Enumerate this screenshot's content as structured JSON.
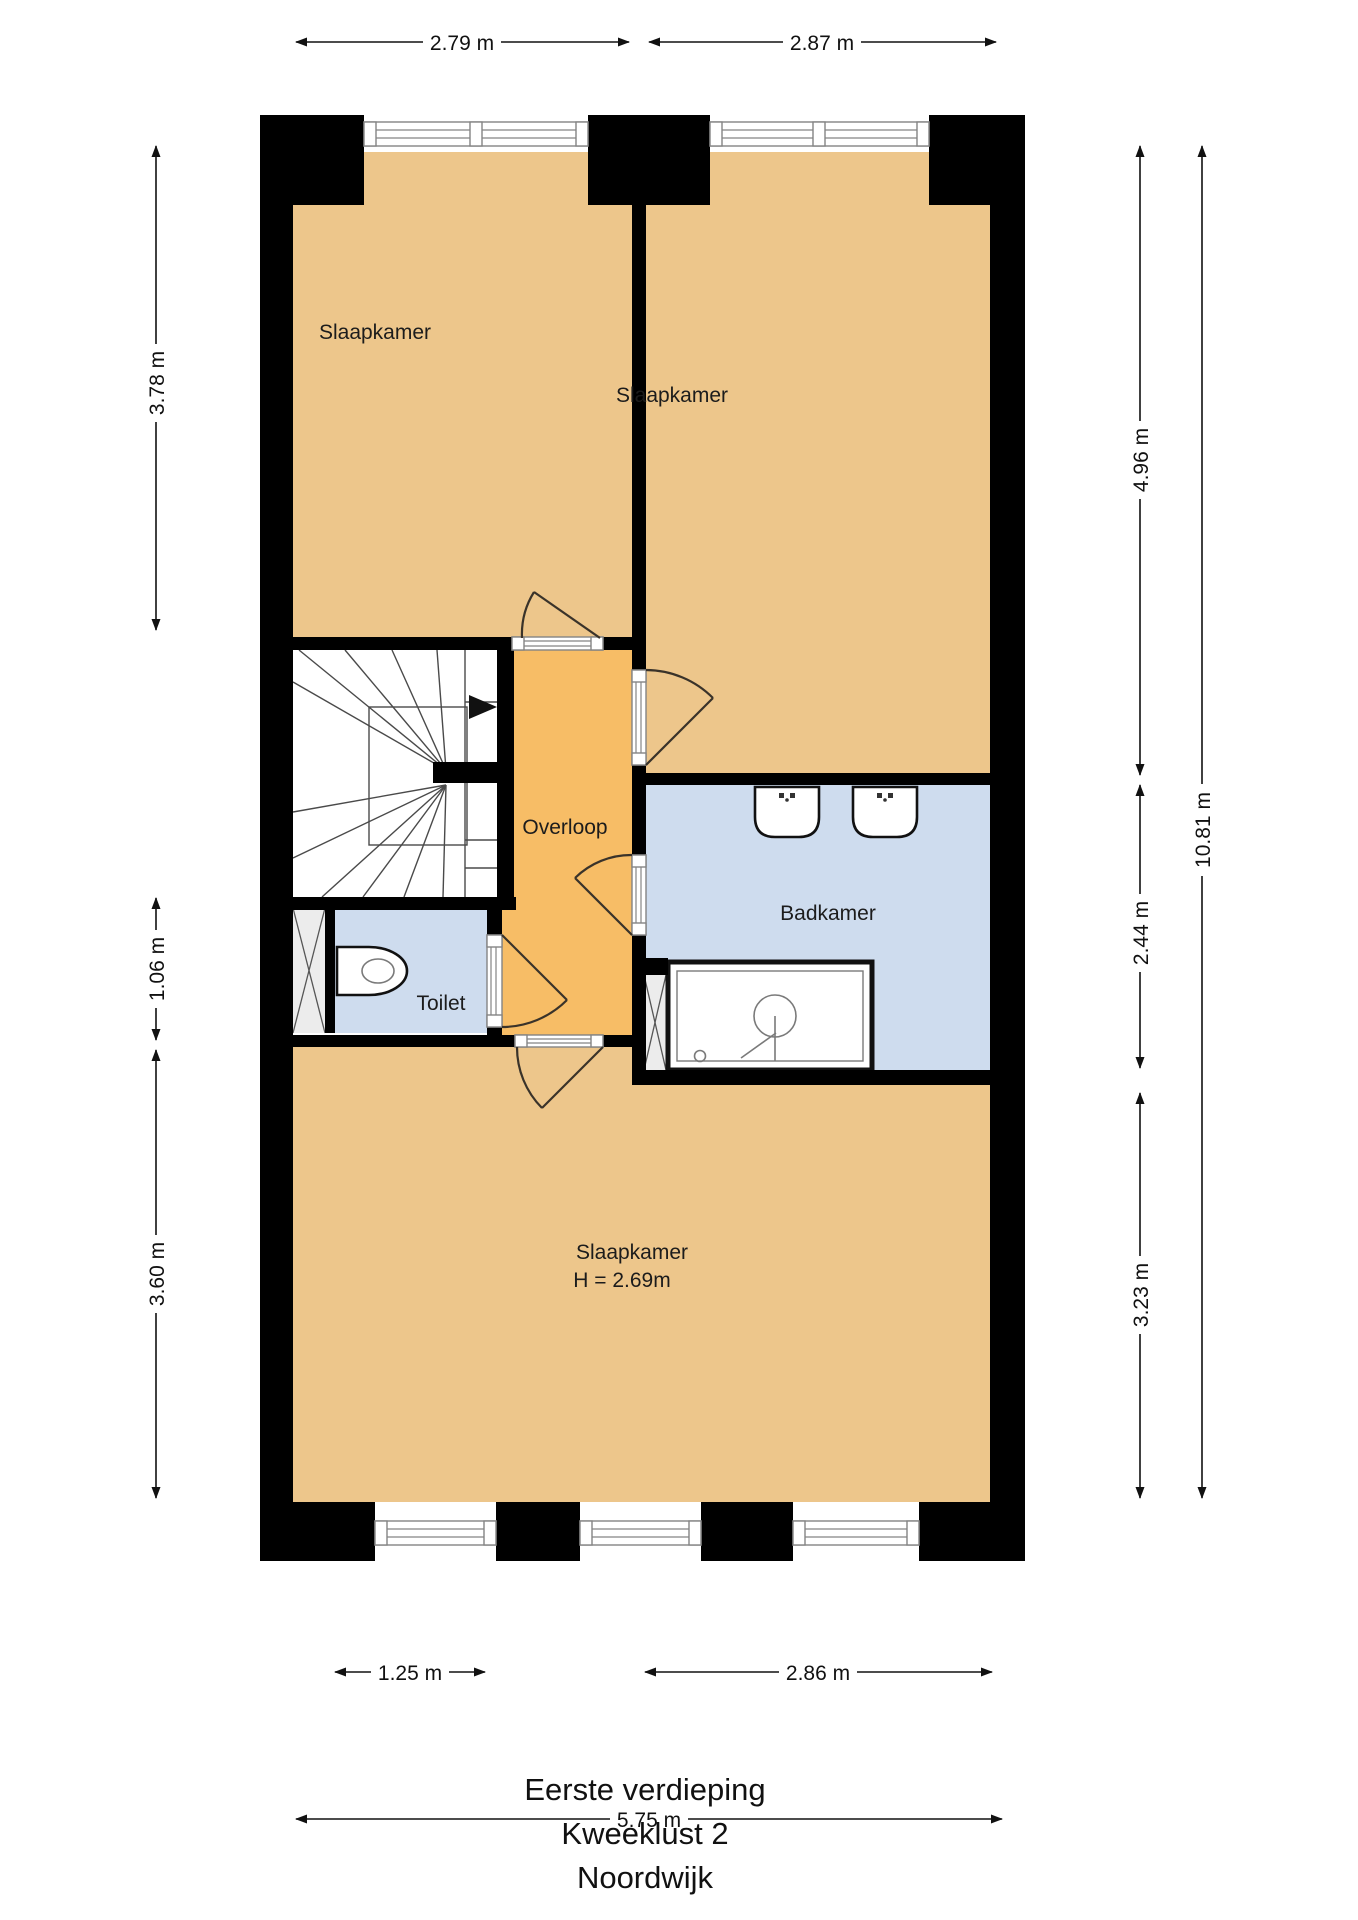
{
  "title": {
    "line1": "Eerste verdieping",
    "line2": "Kweeklust 2",
    "line3": "Noordwijk"
  },
  "rooms": {
    "bedroom_top_left": {
      "label": "Slaapkamer"
    },
    "bedroom_top_right": {
      "label": "Slaapkamer"
    },
    "landing": {
      "label": "Overloop"
    },
    "bathroom": {
      "label": "Badkamer"
    },
    "toilet": {
      "label": "Toilet"
    },
    "bedroom_bottom": {
      "label": "Slaapkamer",
      "height_note": "H = 2.69m"
    }
  },
  "dimensions": {
    "top": [
      {
        "label": "2.79 m"
      },
      {
        "label": "2.87 m"
      }
    ],
    "left": [
      {
        "label": "3.78 m"
      },
      {
        "label": "1.06 m"
      },
      {
        "label": "3.60 m"
      }
    ],
    "right": [
      {
        "label": "4.96 m"
      },
      {
        "label": "2.44 m"
      },
      {
        "label": "3.23 m"
      }
    ],
    "right_overall": {
      "label": "10.81 m"
    },
    "bottom": [
      {
        "label": "1.25 m"
      },
      {
        "label": "2.86 m"
      }
    ],
    "bottom_overall": {
      "label": "5.75 m"
    }
  },
  "colors": {
    "bedroom": "#edc68b",
    "landing": "#f7bd66",
    "wet_room": "#cedcee",
    "wall": "#000000",
    "background": "#ffffff"
  }
}
